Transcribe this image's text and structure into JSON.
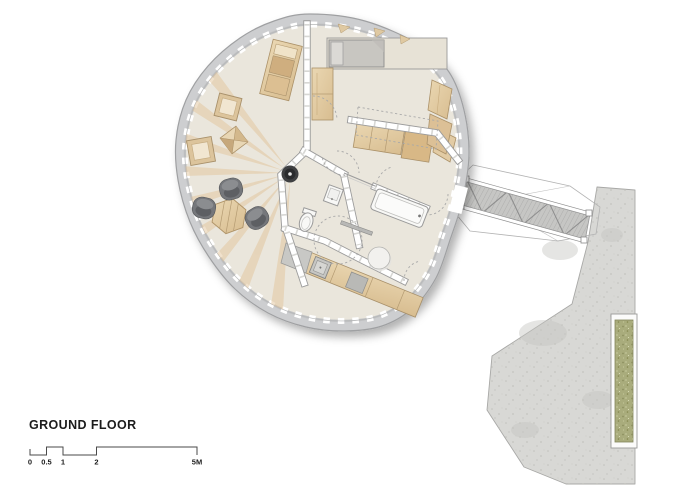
{
  "title": {
    "label": "GROUND FLOOR"
  },
  "scale_bar": {
    "labels": [
      "0",
      "0.5",
      "1",
      "2",
      "5M"
    ],
    "values_meters": [
      0,
      0.5,
      1,
      2,
      5
    ],
    "unit": "M"
  },
  "plan": {
    "drawing_type": "architectural ground floor plan",
    "building": "organic rounded cabin with perimeter window wall",
    "rooms": [
      "living area",
      "bedroom",
      "wc",
      "bathroom",
      "kitchen"
    ],
    "exterior": [
      "truss bridge walkway",
      "concrete terrace",
      "planter strip"
    ],
    "furniture": [
      "bed",
      "wardrobe",
      "shelf desk",
      "cube stools",
      "pyramid stool",
      "hexagonal coffee table",
      "lounge poufs",
      "wood stove",
      "kitchen counter with sink",
      "upper cabinets",
      "bathtub",
      "toilet",
      "washbasin",
      "shower drain",
      "round table"
    ]
  },
  "palette": {
    "floor": "#eae6dc",
    "wall-band": "#cdced0",
    "wall-edge": "#9fa0a2",
    "wood": "#e2cba4",
    "wood-dark": "#d3b283",
    "stripe": "#e2c49a",
    "chair-gray": "#75777b",
    "fixture-white": "#f8f8f6",
    "concrete": "#d8d8d5",
    "planter-green": "#a9ac7c",
    "bed-gray": "#c8c6c1",
    "line": "#9a9a9a",
    "text": "#1c1c1c"
  }
}
